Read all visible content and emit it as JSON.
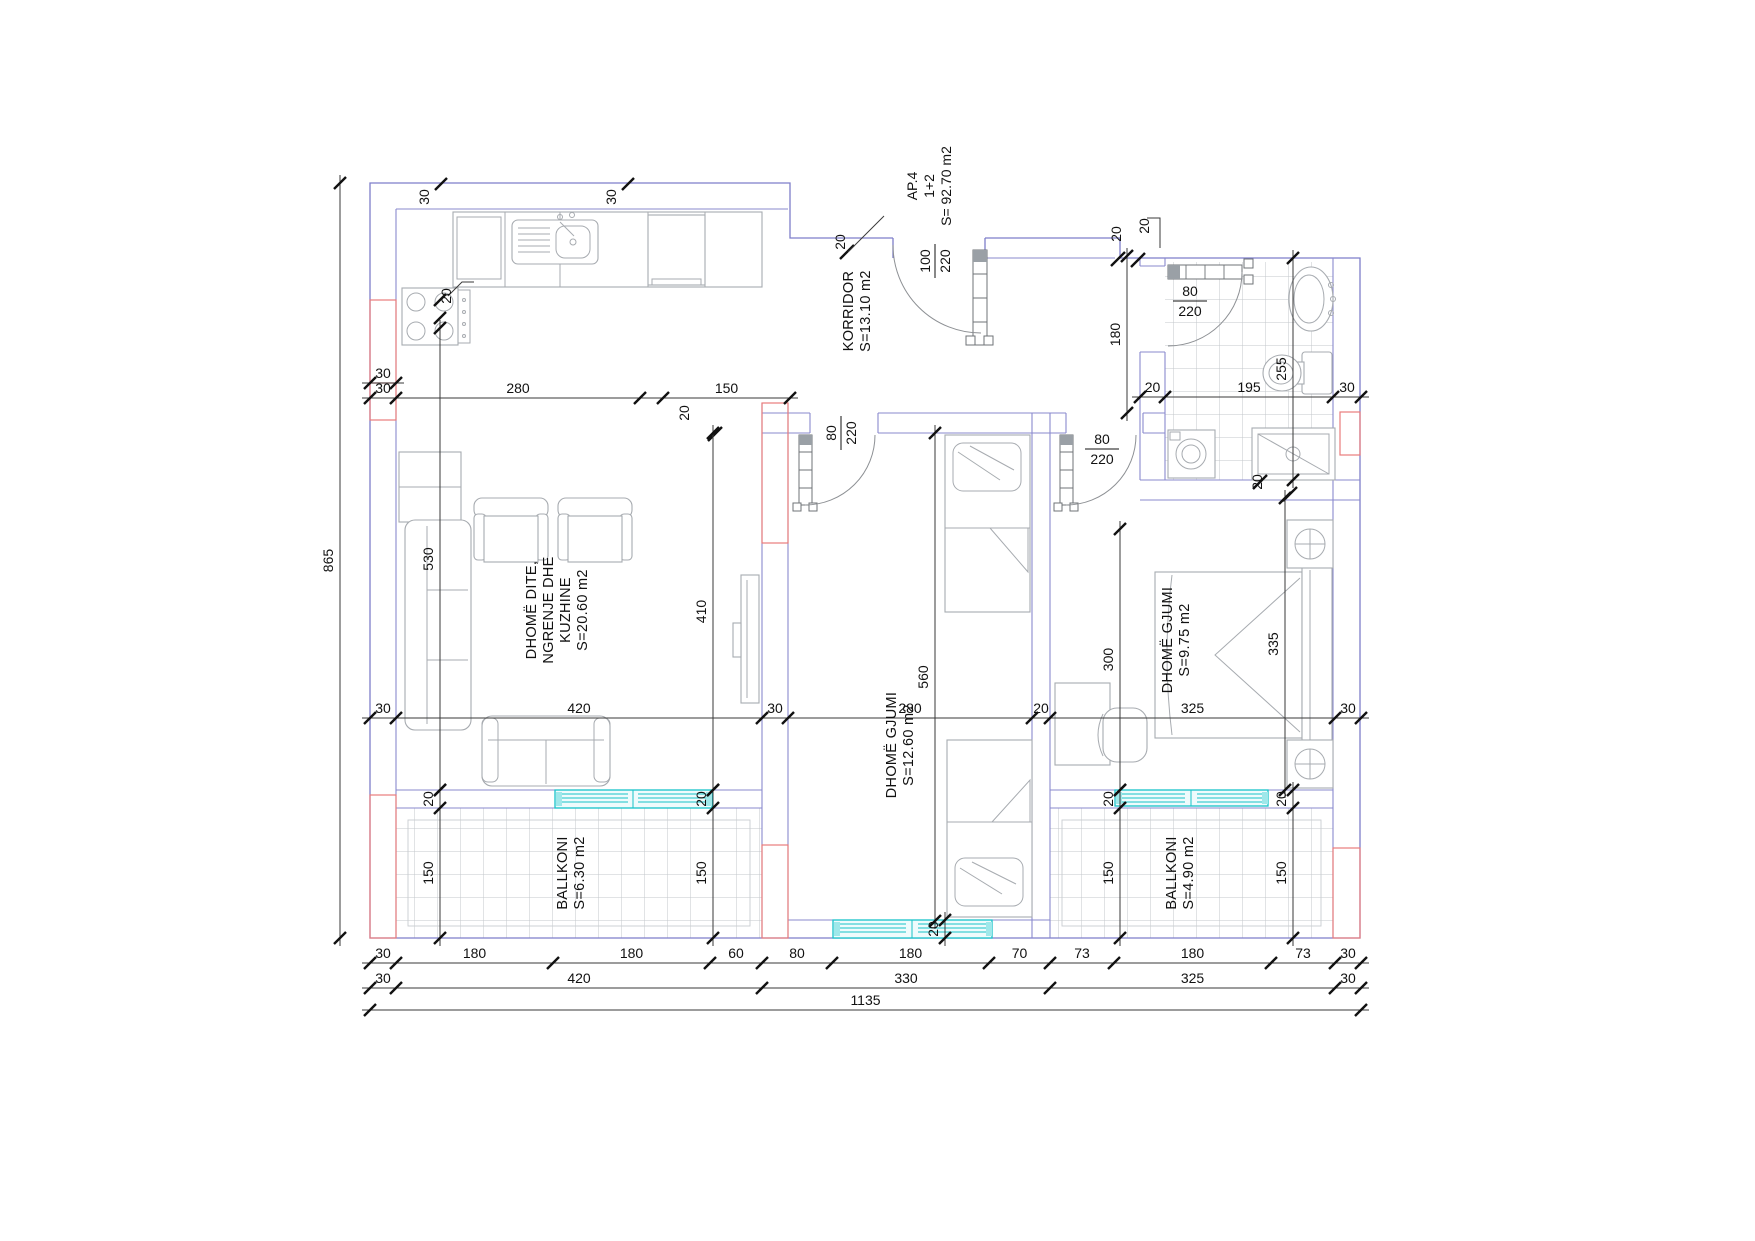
{
  "drawing": {
    "apartment": {
      "code": "AP.4",
      "scheme": "1+2",
      "total_area": "S= 92.70 m2"
    },
    "rooms": [
      {
        "name": "KORRIDOR",
        "area": "S=13.10 m2"
      },
      {
        "name": "DHOMË DITE, NGRENJE DHE KUZHINE",
        "area": "S=20.60 m2"
      },
      {
        "name": "DHOMË GJUMI",
        "area": "S=12.60 m2"
      },
      {
        "name": "DHOMË GJUMI",
        "area": "S=9.75 m2"
      },
      {
        "name": "BALLKONI",
        "area": "S=6.30 m2"
      },
      {
        "name": "BALLKONI",
        "area": "S=4.90 m2"
      }
    ],
    "doors": [
      {
        "size": "100/220",
        "location": "entrance"
      },
      {
        "size": "80/220",
        "location": "bathroom"
      },
      {
        "size": "80/220",
        "location": "bedroom-1"
      },
      {
        "size": "80/220",
        "location": "bedroom-2"
      }
    ],
    "colors": {
      "walls": "#7e7ec9",
      "accent": "#e87c7c",
      "windows": "#17c3c9",
      "furniture": "#a7abb0",
      "text": "#111111"
    }
  },
  "labels": [
    {
      "t": "KORRIDOR",
      "x": 853,
      "y": 311,
      "r": -90,
      "room": true
    },
    {
      "t": "S=13.10 m2",
      "x": 870,
      "y": 311,
      "r": -90,
      "room": true
    },
    {
      "t": "DHOMË DITE,",
      "x": 536,
      "y": 610,
      "r": -90,
      "room": true
    },
    {
      "t": "NGRENJE DHE",
      "x": 553,
      "y": 610,
      "r": -90,
      "room": true
    },
    {
      "t": "KUZHINE",
      "x": 570,
      "y": 610,
      "r": -90,
      "room": true
    },
    {
      "t": "S=20.60 m2",
      "x": 587,
      "y": 610,
      "r": -90,
      "room": true
    },
    {
      "t": "DHOMË GJUMI",
      "x": 896,
      "y": 745,
      "r": -90,
      "room": true
    },
    {
      "t": "S=12.60 m2",
      "x": 913,
      "y": 745,
      "r": -90,
      "room": true
    },
    {
      "t": "DHOMË GJUMI",
      "x": 1172,
      "y": 640,
      "r": -90,
      "room": true
    },
    {
      "t": "S=9.75 m2",
      "x": 1189,
      "y": 640,
      "r": -90,
      "room": true
    },
    {
      "t": "BALLKONI",
      "x": 567,
      "y": 873,
      "r": -90,
      "room": true
    },
    {
      "t": "S=6.30 m2",
      "x": 584,
      "y": 873,
      "r": -90,
      "room": true
    },
    {
      "t": "BALLKONI",
      "x": 1176,
      "y": 873,
      "r": -90,
      "room": true
    },
    {
      "t": "S=4.90 m2",
      "x": 1193,
      "y": 873,
      "r": -90,
      "room": true
    },
    {
      "t": "AP.4",
      "x": 917,
      "y": 186,
      "r": -90
    },
    {
      "t": "1+2",
      "x": 934,
      "y": 186,
      "r": -90
    },
    {
      "t": "S= 92.70 m2",
      "x": 951,
      "y": 186,
      "r": -90
    },
    {
      "t": "30",
      "x": 429,
      "y": 197,
      "r": -90
    },
    {
      "t": "30",
      "x": 616,
      "y": 197,
      "r": -90
    },
    {
      "t": "20",
      "x": 451,
      "y": 296,
      "r": -90
    },
    {
      "t": "20",
      "x": 845,
      "y": 242,
      "r": -90
    },
    {
      "t": "20",
      "x": 1121,
      "y": 234,
      "r": -90
    },
    {
      "t": "20",
      "x": 1149,
      "y": 226,
      "r": -90
    },
    {
      "t": "20",
      "x": 689,
      "y": 413,
      "r": -90
    },
    {
      "t": "20",
      "x": 1262,
      "y": 482,
      "r": -90
    },
    {
      "top": "100",
      "bot": "220",
      "x": 934,
      "y": 261,
      "r": -90
    },
    {
      "top": "80",
      "bot": "220",
      "x": 840,
      "y": 433,
      "r": -90
    },
    {
      "top": "80",
      "bot": "220",
      "x": 1190,
      "y": 300
    },
    {
      "top": "80",
      "bot": "220",
      "x": 1102,
      "y": 448
    }
  ],
  "dims": [
    {
      "d": "h",
      "y": 963,
      "b": [
        370,
        396,
        553,
        710,
        762,
        832,
        989,
        1050,
        1114,
        1271,
        1335,
        1361
      ],
      "l": [
        "30",
        "180",
        "180",
        "60",
        "80",
        "180",
        "70",
        "73",
        "180",
        "73",
        "30"
      ]
    },
    {
      "d": "h",
      "y": 988,
      "b": [
        370,
        396,
        762,
        1050,
        1335,
        1361
      ],
      "l": [
        "30",
        "420",
        "330",
        "325",
        "30"
      ]
    },
    {
      "d": "h",
      "y": 1010,
      "b": [
        370,
        1361
      ],
      "l": [
        "1135"
      ]
    },
    {
      "d": "h",
      "y": 718,
      "b": [
        370,
        396,
        762,
        788,
        1032,
        1050,
        1335,
        1361
      ],
      "l": [
        "30",
        "420",
        "30",
        "280",
        "20",
        "325",
        "30"
      ]
    },
    {
      "d": "h",
      "y": 398,
      "b": [
        370,
        396,
        640,
        663,
        790
      ],
      "l": [
        "30",
        "280",
        "",
        "150"
      ]
    },
    {
      "d": "h",
      "y": 397,
      "b": [
        1140,
        1165,
        1333,
        1361
      ],
      "l": [
        "20",
        "195",
        "30"
      ]
    },
    {
      "d": "h",
      "y": 383,
      "b": [
        370,
        396
      ],
      "l": [
        "30"
      ]
    },
    {
      "d": "v",
      "x": 340,
      "b": [
        183,
        938
      ],
      "l": [
        "865"
      ]
    },
    {
      "d": "v",
      "x": 440,
      "b": [
        328,
        790
      ],
      "l": [
        "530"
      ]
    },
    {
      "d": "v",
      "x": 713,
      "b": [
        433,
        790
      ],
      "l": [
        "410"
      ]
    },
    {
      "d": "v",
      "x": 935,
      "b": [
        433,
        921
      ],
      "l": [
        "560"
      ]
    },
    {
      "d": "v",
      "x": 1120,
      "b": [
        529,
        790
      ],
      "l": [
        "300"
      ]
    },
    {
      "d": "v",
      "x": 1285,
      "b": [
        498,
        790
      ],
      "l": [
        "335"
      ]
    },
    {
      "d": "v",
      "x": 1293,
      "b": [
        258,
        480
      ],
      "l": [
        "255"
      ]
    },
    {
      "d": "v",
      "x": 1127,
      "b": [
        256,
        413
      ],
      "l": [
        "180"
      ]
    },
    {
      "d": "v",
      "x": 440,
      "b": [
        790,
        808,
        938
      ],
      "l": [
        "20",
        "150"
      ]
    },
    {
      "d": "v",
      "x": 713,
      "b": [
        790,
        808,
        938
      ],
      "l": [
        "20",
        "150"
      ]
    },
    {
      "d": "v",
      "x": 1120,
      "b": [
        790,
        808,
        938
      ],
      "l": [
        "20",
        "150"
      ]
    },
    {
      "d": "v",
      "x": 1293,
      "b": [
        790,
        808,
        938
      ],
      "l": [
        "20",
        "150"
      ]
    },
    {
      "d": "v",
      "x": 945,
      "b": [
        920,
        938
      ],
      "l": [
        "20"
      ]
    }
  ]
}
